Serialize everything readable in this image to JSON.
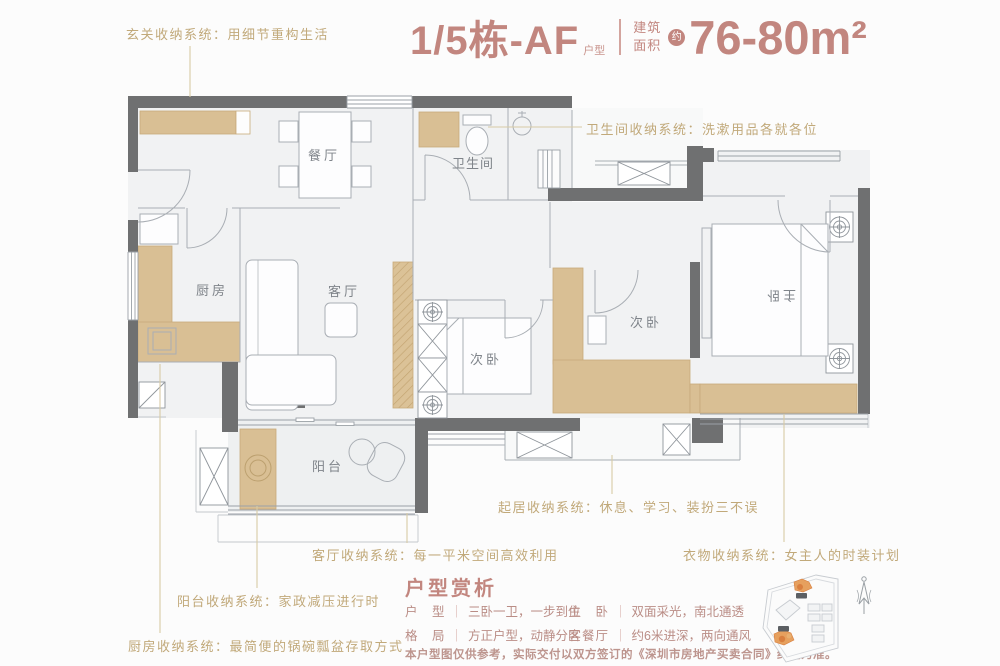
{
  "title": {
    "unit": "1/5栋-AF",
    "unit_suffix": "户型",
    "area_label_line1": "建筑",
    "area_label_line2": "面积",
    "approx_badge": "约",
    "area_value": "76-80m²"
  },
  "annotations": {
    "entry": "玄关收纳系统：用细节重构生活",
    "bathroom": "卫生间收纳系统：洗漱用品各就各位",
    "living_storage": "起居收纳系统：休息、学习、装扮三不误",
    "livingroom": "客厅收纳系统：每一平米空间高效利用",
    "wardrobe": "衣物收纳系统：女主人的时装计划",
    "balcony": "阳台收纳系统：家政减压进行时",
    "kitchen": "厨房收纳系统：最简便的锅碗瓢盆存取方式"
  },
  "rooms": {
    "dining": "餐厅",
    "bathroom": "卫生间",
    "kitchen": "厨房",
    "living": "客厅",
    "bedroom_left": "次卧",
    "bedroom_right": "次卧",
    "master": "主卧",
    "balcony": "阳台"
  },
  "analysis": {
    "heading": "户型赏析",
    "separator": "｜",
    "items": [
      {
        "label": "户　型",
        "value": "三卧一卫，一步到位"
      },
      {
        "label": "主　卧",
        "value": "双面采光，南北通透"
      },
      {
        "label": "格　局",
        "value": "方正户型，动静分区"
      },
      {
        "label": "客餐厅",
        "value": "约6米进深，两向通风"
      }
    ],
    "disclaimer": "本户型图仅供参考，实际交付以双方签订的《深圳市房地产买卖合同》约定为准。"
  },
  "colors": {
    "accent_rose": "#c2867f",
    "annotation_gold": "#c1a97a",
    "wall_gray": "#6f7071",
    "cabinet_tan": "#d9bf94",
    "site_orange": "#e6a05e"
  }
}
